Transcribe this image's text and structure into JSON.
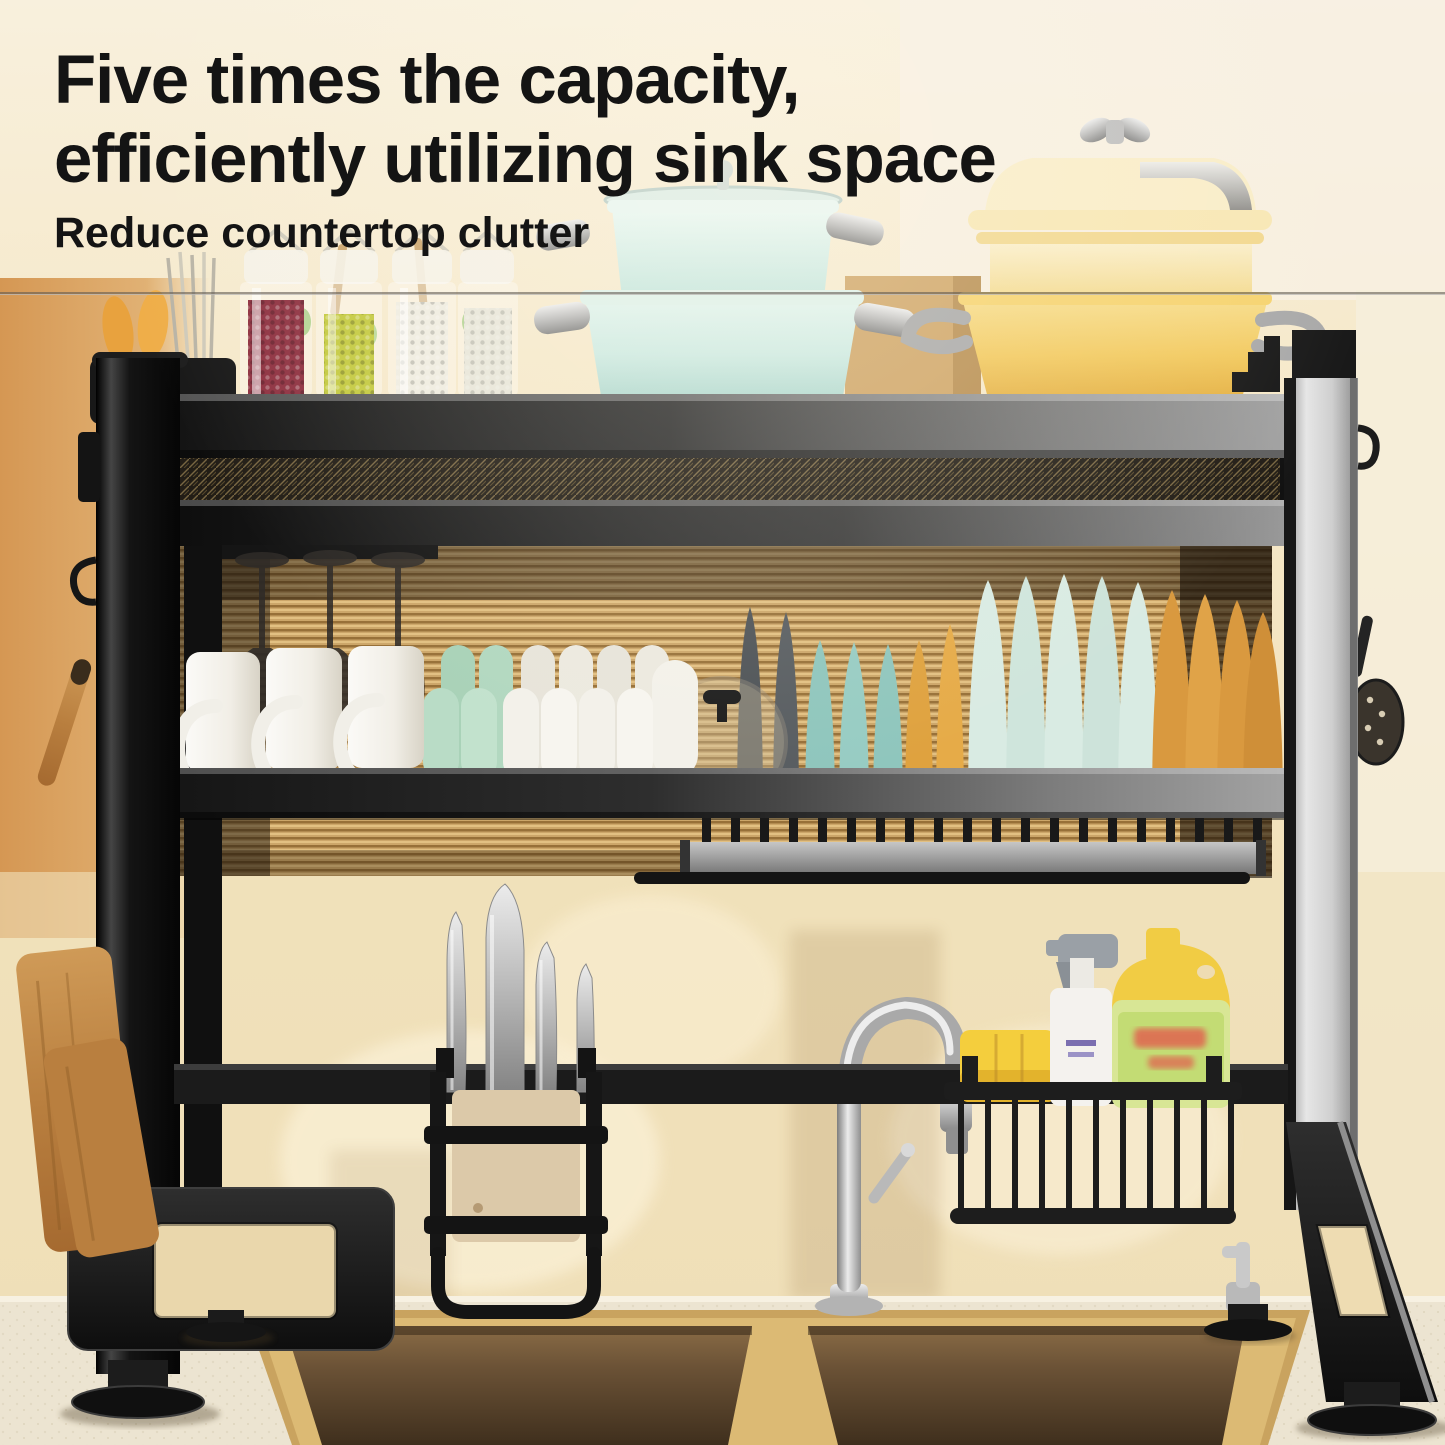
{
  "header": {
    "headline_line1": "Five times the capacity,",
    "headline_line2": "efficiently utilizing sink space",
    "subtitle": "Reduce countertop clutter",
    "text_color": "#141414"
  },
  "palette": {
    "background_top": "#f6ecd7",
    "background_right": "#f7efe3",
    "wall_left_warm": "#d59753",
    "ribbed_glass_panel": "#c89f5d",
    "rack_black": "#1b1b1b",
    "rack_silver": "#b9b9b9",
    "divider_line": "#605a52",
    "teal_pot": "#cdeae2",
    "yellow_pot": "#f2c95e",
    "mint_bowl": "#b9dcc6",
    "white_dish": "#f3f1ea",
    "teal_plate": "#8fc6bd",
    "amber_plate": "#d9993f",
    "pale_mint_plate": "#d9ebe3",
    "dark_plate": "#4e5357",
    "wood_board": "#b97f3f",
    "sponge_yellow": "#f4ce3d",
    "detergent_body": "#d8e695",
    "detergent_cap": "#f1cc44",
    "detergent_label": "#c3dc74",
    "spray_bottle": "#f4f2ee",
    "red_beans_jar": "#8e3040",
    "green_beans_jar": "#c3c93e",
    "white_beans_jar": "#efece1",
    "sink_rim_gold": "#c9a35f",
    "sink_basin_brown": "#5d472e",
    "countertop": "#ece4d1",
    "chrome": "#c9c9c9"
  },
  "scene": {
    "top_shelf_items": [
      "utensil-cup",
      "spice-jars",
      "teal-pot-stack",
      "yellow-pot-stack"
    ],
    "middle_shelf_items": [
      "wine-glasses",
      "mugs",
      "bowls",
      "glass-pot-lid",
      "plate-rack"
    ],
    "lower_items": [
      "knife-holder",
      "chrome-faucet",
      "sponge-basket",
      "cutting-boards",
      "double-bowl-sink",
      "soap-dispenser"
    ]
  }
}
